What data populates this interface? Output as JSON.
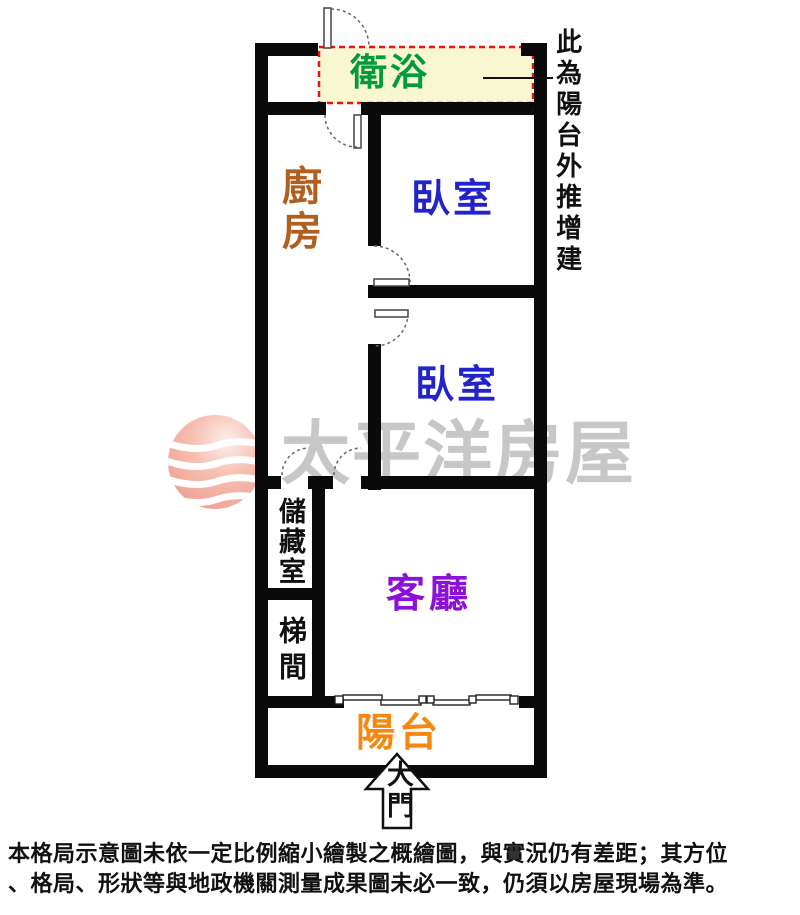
{
  "watermark": {
    "brand_text": "太平洋房屋",
    "logo_icon": "pacific-sphere-logo",
    "text_color": "#c7c7c7",
    "logo_pink": "#f3a99c"
  },
  "rooms": {
    "bathroom": {
      "label": "衛浴",
      "color": "#009b3a"
    },
    "kitchen": {
      "label": "廚房",
      "color": "#b05f1e"
    },
    "bedroom1": {
      "label": "臥室",
      "color": "#2323cc"
    },
    "bedroom2": {
      "label": "臥室",
      "color": "#2323cc"
    },
    "storage": {
      "label": "儲藏室",
      "color": "#111111"
    },
    "stairwell": {
      "label": "梯間",
      "color": "#111111"
    },
    "living": {
      "label": "客廳",
      "color": "#8b10d8"
    },
    "balcony": {
      "label": "陽台",
      "color": "#f6870f"
    },
    "entrance": {
      "label": "大門",
      "color": "#111111"
    }
  },
  "annotation": {
    "callout_text": "此為陽台外推增建"
  },
  "bathroom_highlight": {
    "fill": "#f8f7d2",
    "border_color": "#ee1111",
    "border_style": "dashed"
  },
  "plan": {
    "wall_color": "#0a0a0a"
  },
  "disclaimer": {
    "line1": "本格局示意圖未依一定比例縮小繪製之概繪圖，與實況仍有差距；其方位",
    "line2": "、格局、形狀等與地政機關測量成果圖未必一致，仍須以房屋現場為準。"
  }
}
